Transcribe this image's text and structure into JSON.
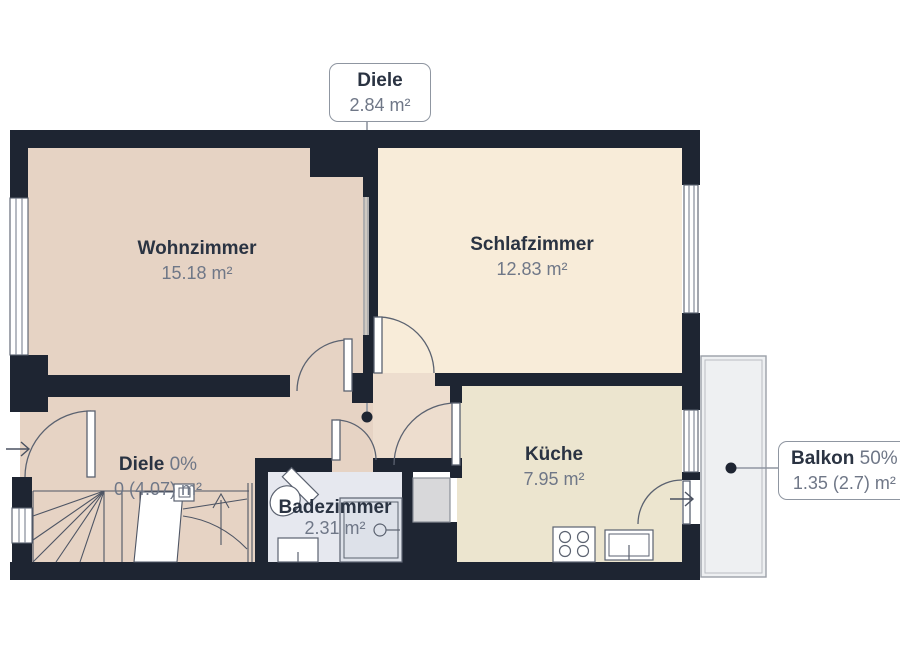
{
  "title_callout": {
    "room": "Diele",
    "area": "2.84 m²"
  },
  "balcony_callout": {
    "room": "Balkon",
    "share": "50%",
    "area": "1.35 (2.7) m²"
  },
  "rooms": {
    "wohnzimmer": {
      "name": "Wohnzimmer",
      "area": "15.18 m²"
    },
    "schlafzimmer": {
      "name": "Schlafzimmer",
      "area": "12.83 m²"
    },
    "diele": {
      "name": "Diele",
      "share": "0%",
      "area": "0 (4.07) m²"
    },
    "badezimmer": {
      "name": "Badezimmer",
      "area": "2.31 m²"
    },
    "kueche": {
      "name": "Küche",
      "area": "7.95 m²"
    }
  },
  "icons": {
    "entry_arrow": "→",
    "balcony_arrow": "→",
    "stairs_up_arrow": "↑"
  },
  "colors": {
    "wall": "#1e2532",
    "floor_living": "#e6d3c4",
    "floor_bedroom": "#f8ecd9",
    "floor_hall": "#edddce",
    "floor_kitchen": "#ece5cf",
    "floor_bath": "#e6e8ef",
    "floor_balcony": "#eef0f2",
    "appliance_gray": "#d8d8da",
    "line_gray": "#5b6270",
    "leader_gray": "#8f96a1",
    "text_dark": "#2a3342",
    "text_gray": "#6f7787"
  }
}
